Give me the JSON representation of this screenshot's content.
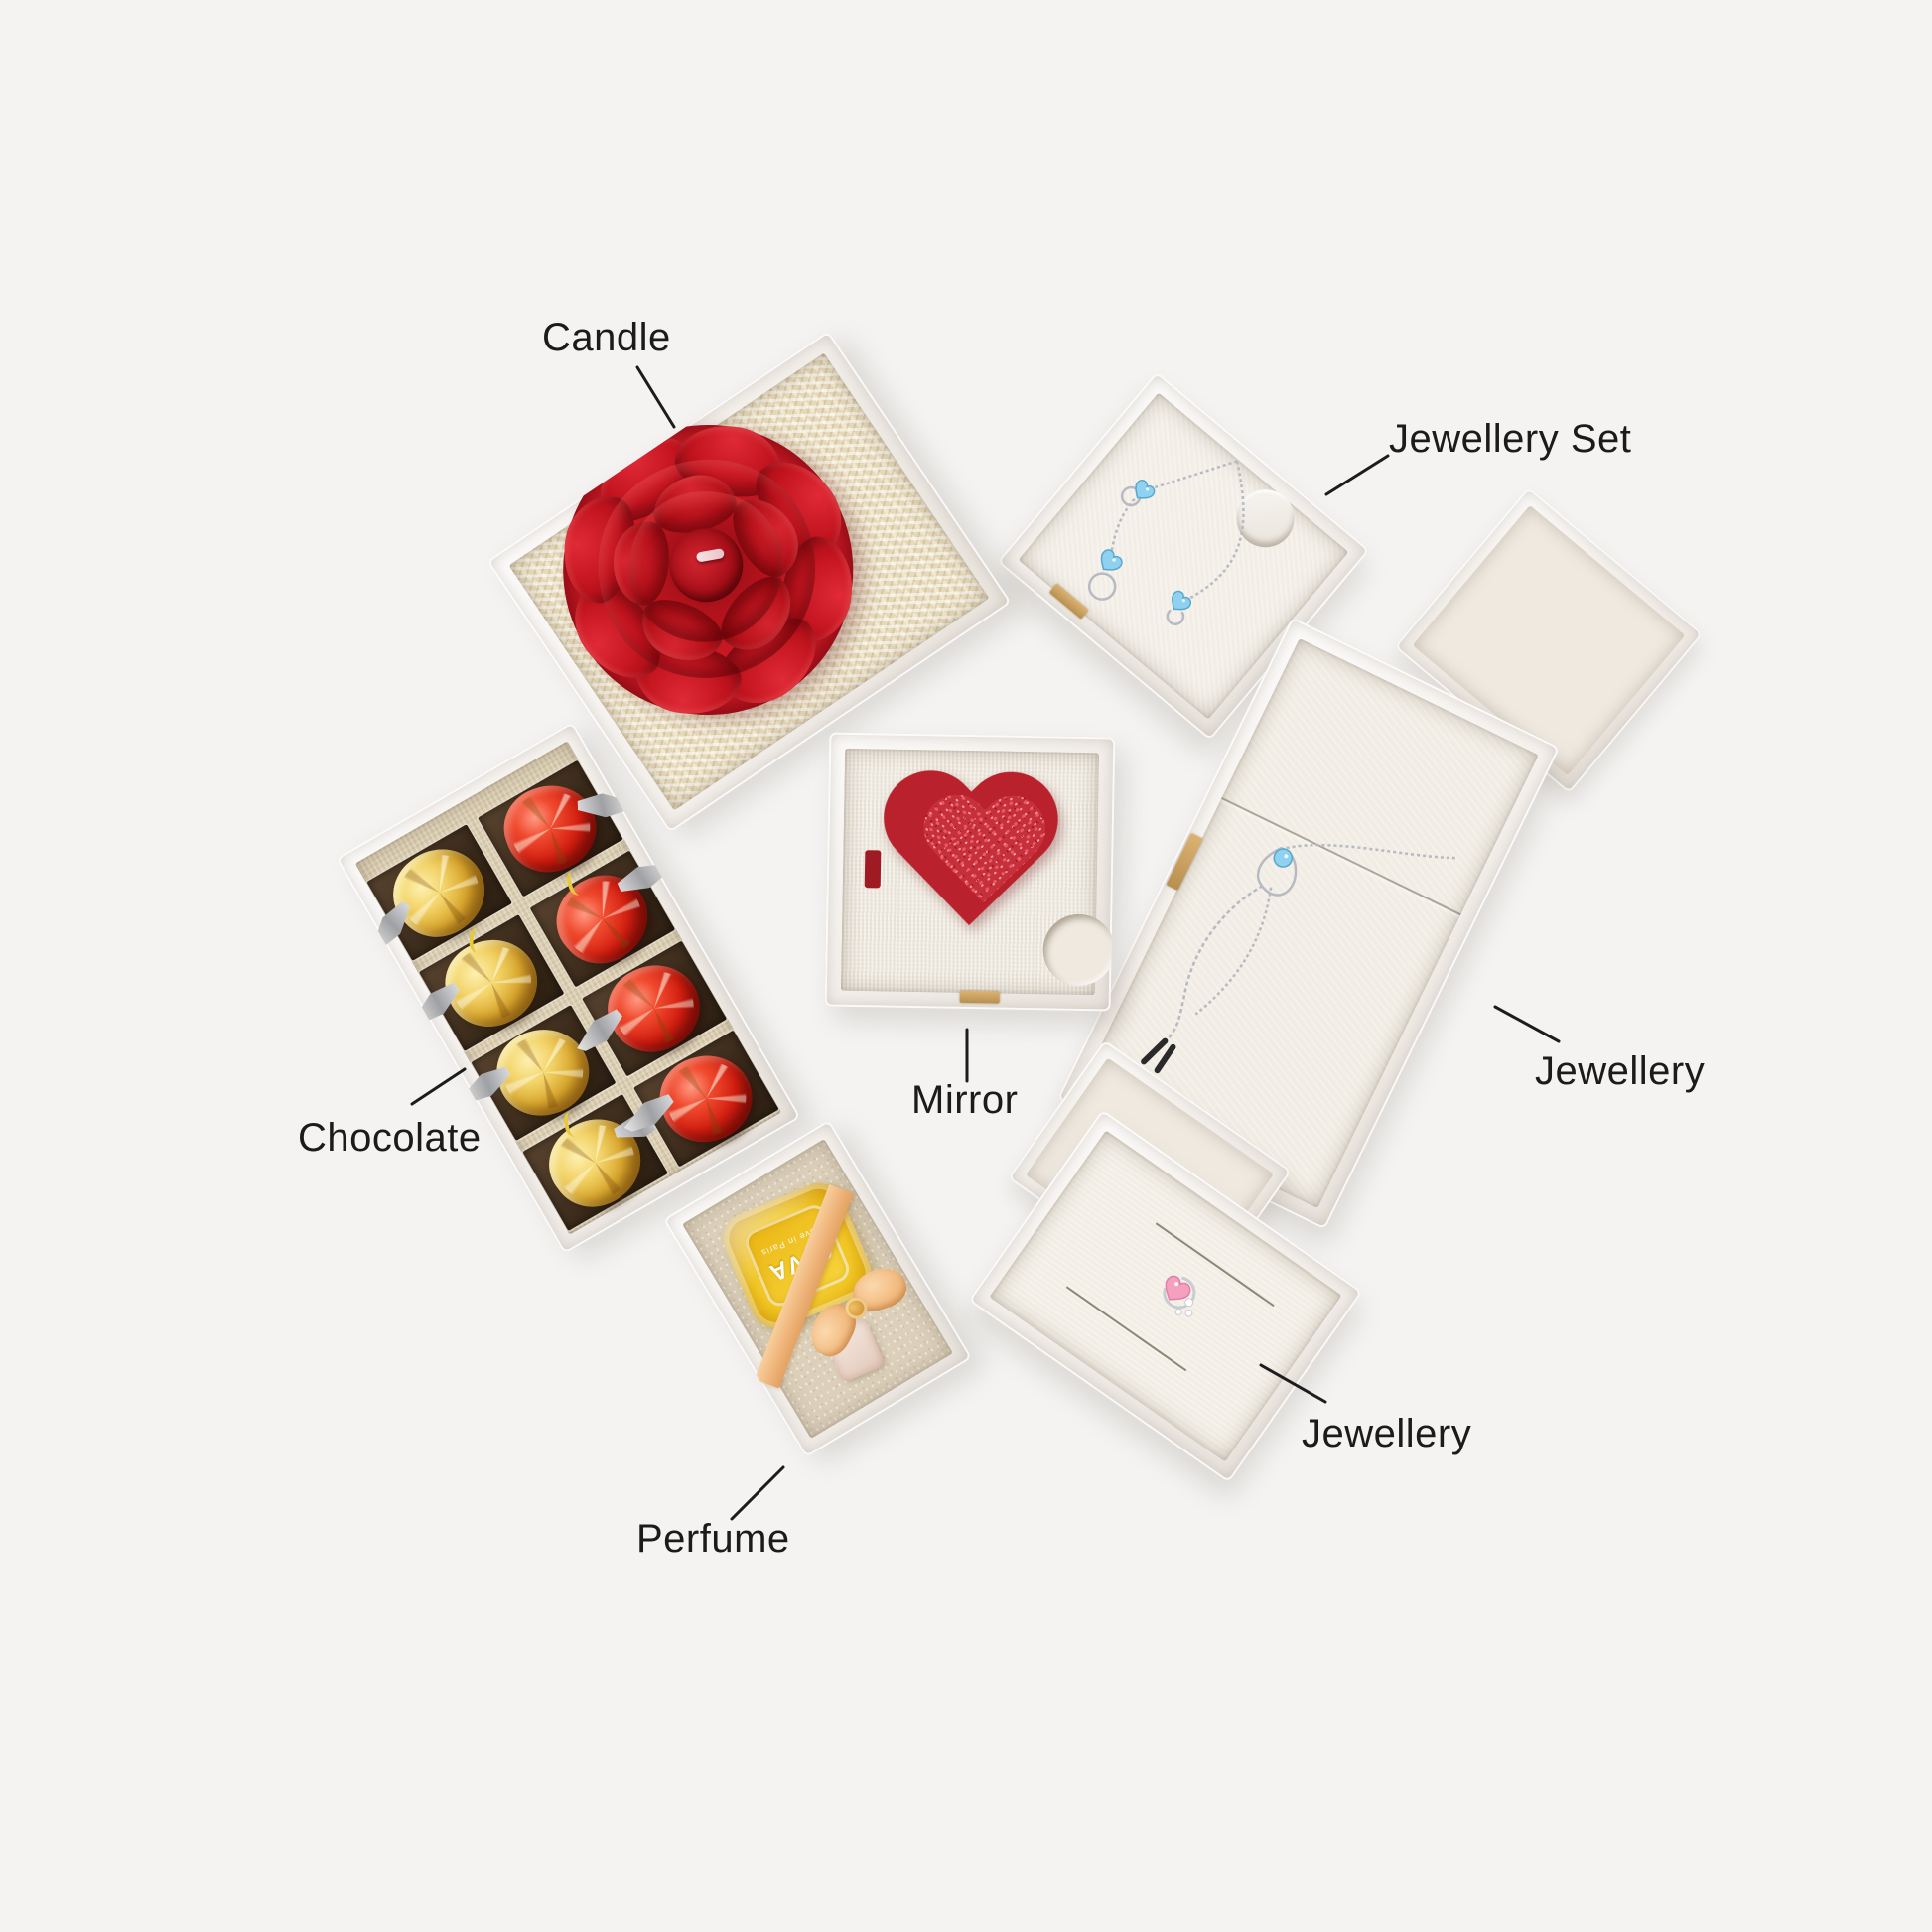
{
  "labels": {
    "candle": "Candle",
    "jewellery_set": "Jewellery Set",
    "chocolate": "Chocolate",
    "mirror": "Mirror",
    "perfume": "Perfume",
    "jewellery_right": "Jewellery",
    "jewellery_bottom": "Jewellery"
  },
  "perfume_bottle": {
    "brand": "GIVA",
    "tagline": "Love in Paris"
  },
  "colors": {
    "background": "#f4f3f2",
    "label_text": "#1b1b1b",
    "leader_line": "#1c1c1c",
    "box_wall": "#f6f2ee",
    "liner_cream": "#f1ece3",
    "liner_tan": "#d8cbae",
    "shredded_paper": "#e6d9ba",
    "rose_red": "#c2151f",
    "heart_red": "#b9222c",
    "glitter_red": "#c5303a",
    "gold_foil": "#e8c050",
    "red_foil": "#d21e10",
    "perfume_yellow": "#f2c724",
    "ribbon_peach": "#f2b97e",
    "stone_blue": "#8ed1f0",
    "stone_pink": "#f6a0c0",
    "silver": "#b7bac1"
  }
}
